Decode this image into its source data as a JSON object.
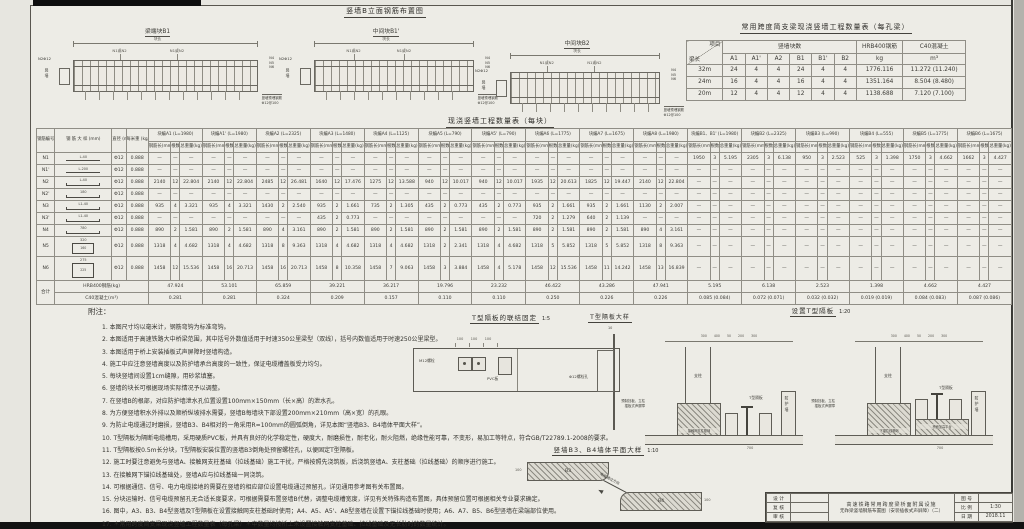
{
  "page": {
    "bg": "#e7e6e0",
    "line_color": "#59564f",
    "accent": "#121212"
  },
  "elevation": {
    "title": "竖墙B立面钢筋布置图",
    "diagrams": [
      {
        "title": "梁端块B1",
        "dim_label": "块长",
        "bar_label": "N1或N2",
        "left_label": "N2Φ12",
        "side_label": "竖墙",
        "right_labels": [
          "N4",
          "N5",
          "N6"
        ],
        "note_line1": "竖墙预埋钢筋",
        "note_line2": "Φ12@100"
      },
      {
        "title": "中间块B1'",
        "dim_label": "块长",
        "bar_label": "N1或N2",
        "left_label": "N2Φ12",
        "side_label": "竖墙",
        "right_labels": [
          "N4",
          "N5",
          "N6"
        ],
        "note_line1": "竖墙预埋钢筋",
        "note_line2": "Φ12@100"
      },
      {
        "title": "中间块B2",
        "dim_label": "块长",
        "bar_label": "N1或N2",
        "left_label": "N2Φ12",
        "side_label": "竖墙",
        "right_labels": [
          "N4",
          "N5",
          "N6"
        ],
        "note_line1": "竖墙预埋钢筋",
        "note_line2": "Φ12@100"
      }
    ]
  },
  "span_table": {
    "title": "常用跨度简支梁现浇竖墙工程数量表（每孔梁）",
    "corner_top": "项目",
    "corner_bottom": "梁长",
    "group_header": "竖墙块数",
    "block_cols": [
      "A1",
      "A1'",
      "A2",
      "B1",
      "B1'",
      "B2"
    ],
    "steel_header": "HRB400钢筋",
    "steel_unit": "kg",
    "concrete_header": "C40混凝土",
    "concrete_unit": "m³",
    "rows": [
      {
        "span": "32m",
        "blocks": [
          "24",
          "4",
          "4",
          "24",
          "4",
          "4"
        ],
        "steel": "1776.116",
        "concrete": "11.272 (11.240)"
      },
      {
        "span": "24m",
        "blocks": [
          "16",
          "4",
          "4",
          "16",
          "4",
          "4"
        ],
        "steel": "1351.164",
        "concrete": "8.504 (8.480)"
      },
      {
        "span": "20m",
        "blocks": [
          "12",
          "4",
          "4",
          "12",
          "4",
          "4"
        ],
        "steel": "1138.688",
        "concrete": "7.120 (7.100)"
      }
    ]
  },
  "main_table": {
    "title": "现浇竖墙工程数量表（每块）",
    "left_headers": [
      "钢筋编号",
      "钢 筋 大 样 (mm)",
      "直径 (mm)",
      "每米重 (kg/m)"
    ],
    "sub_headers": [
      "钢筋长(mm)",
      "根数",
      "总重量(kg)"
    ],
    "groups": [
      "块编A1 (L=1980)",
      "块编A1' (L=1980)",
      "块编A2 (L=2325)",
      "块编A3 (L=1480)",
      "块编A4 (L=1125)",
      "块编A5 (L=790)",
      "块编A5' (L=790)",
      "块编A6 (L=1775)",
      "块编A7 (L=1675)",
      "块编A8 (L=1980)",
      "块编B1、B1' (L=1980)",
      "块编B2 (L=2325)",
      "块编B3 (L=990)",
      "块编B4 (L=555)",
      "块编B5 (L=1775)",
      "块编B6 (L=1675)"
    ],
    "rows": [
      {
        "id": "N1",
        "shape": "line",
        "sketch": "L-40",
        "dia": "Φ12",
        "unit_weight": "0.888",
        "tall": 0,
        "cells": [
          null,
          null,
          null,
          null,
          null,
          null,
          null,
          null,
          null,
          null,
          [
            "1950",
            "3",
            "5.195"
          ],
          [
            "2305",
            "3",
            "6.138"
          ],
          [
            "950",
            "3",
            "2.523"
          ],
          [
            "525",
            "3",
            "1.398"
          ],
          [
            "1750",
            "3",
            "4.662"
          ],
          [
            "1662",
            "3",
            "4.427"
          ]
        ]
      },
      {
        "id": "N1'",
        "shape": "line",
        "sketch": "L-200",
        "dia": "Φ12",
        "unit_weight": "0.888",
        "tall": 0,
        "cells": [
          null,
          null,
          null,
          null,
          null,
          null,
          null,
          null,
          null,
          null,
          null,
          null,
          null,
          null,
          null,
          null
        ]
      },
      {
        "id": "N2",
        "shape": "hook",
        "sketch": "L-40",
        "dia": "Φ12",
        "unit_weight": "0.888",
        "tall": 0,
        "cells": [
          [
            "2140",
            "12",
            "22.804"
          ],
          [
            "2140",
            "12",
            "22.804"
          ],
          [
            "2485",
            "12",
            "26.481"
          ],
          [
            "1640",
            "12",
            "17.476"
          ],
          [
            "1275",
            "12",
            "13.588"
          ],
          [
            "940",
            "12",
            "10.017"
          ],
          [
            "940",
            "12",
            "10.017"
          ],
          [
            "1935",
            "12",
            "20.613"
          ],
          [
            "1825",
            "12",
            "19.447"
          ],
          [
            "2140",
            "12",
            "22.804"
          ],
          null,
          null,
          null,
          null,
          null,
          null
        ]
      },
      {
        "id": "N2'",
        "shape": "hook",
        "sketch": "180",
        "dia": "Φ12",
        "unit_weight": "0.888",
        "tall": 0,
        "cells": [
          null,
          null,
          null,
          null,
          null,
          null,
          null,
          null,
          null,
          null,
          null,
          null,
          null,
          null,
          null,
          null
        ]
      },
      {
        "id": "N3",
        "shape": "hook",
        "sketch": "L1-40",
        "dia": "Φ12",
        "unit_weight": "0.888",
        "tall": 0,
        "cells": [
          [
            "935",
            "4",
            "3.321"
          ],
          [
            "935",
            "4",
            "3.321"
          ],
          [
            "1430",
            "2",
            "2.540"
          ],
          [
            "935",
            "2",
            "1.661"
          ],
          [
            "735",
            "2",
            "1.305"
          ],
          [
            "435",
            "2",
            "0.773"
          ],
          [
            "435",
            "2",
            "0.773"
          ],
          [
            "935",
            "2",
            "1.661"
          ],
          [
            "935",
            "2",
            "1.661"
          ],
          [
            "1130",
            "2",
            "2.007"
          ],
          null,
          null,
          null,
          null,
          null,
          null
        ]
      },
      {
        "id": "N3'",
        "shape": "hook",
        "sketch": "L1-40",
        "dia": "Φ12",
        "unit_weight": "0.888",
        "tall": 0,
        "cells": [
          null,
          null,
          null,
          [
            "435",
            "2",
            "0.773"
          ],
          null,
          null,
          null,
          [
            "720",
            "2",
            "1.279"
          ],
          [
            "640",
            "2",
            "1.139"
          ],
          null,
          null,
          null,
          null,
          null,
          null,
          null
        ]
      },
      {
        "id": "N4",
        "shape": "hook",
        "sketch": "780",
        "dia": "Φ12",
        "unit_weight": "0.888",
        "tall": 0,
        "cells": [
          [
            "890",
            "2",
            "1.581"
          ],
          [
            "890",
            "2",
            "1.581"
          ],
          [
            "890",
            "4",
            "3.161"
          ],
          [
            "890",
            "2",
            "1.581"
          ],
          [
            "890",
            "2",
            "1.581"
          ],
          [
            "890",
            "2",
            "1.581"
          ],
          [
            "890",
            "2",
            "1.581"
          ],
          [
            "890",
            "2",
            "1.581"
          ],
          [
            "890",
            "2",
            "1.581"
          ],
          [
            "890",
            "4",
            "3.161"
          ],
          null,
          null,
          null,
          null,
          null,
          null
        ]
      },
      {
        "id": "N5",
        "shape": "rect",
        "sketch": "320",
        "sketch2": "160",
        "dia": "Φ12",
        "unit_weight": "0.888",
        "tall": 1,
        "cells": [
          [
            "1318",
            "4",
            "4.682"
          ],
          [
            "1318",
            "4",
            "4.682"
          ],
          [
            "1318",
            "8",
            "9.363"
          ],
          [
            "1318",
            "4",
            "4.682"
          ],
          [
            "1318",
            "4",
            "4.682"
          ],
          [
            "1318",
            "2",
            "2.341"
          ],
          [
            "1318",
            "4",
            "4.682"
          ],
          [
            "1318",
            "5",
            "5.852"
          ],
          [
            "1318",
            "5",
            "5.852"
          ],
          [
            "1318",
            "8",
            "9.363"
          ],
          null,
          null,
          null,
          null,
          null,
          null
        ]
      },
      {
        "id": "N6",
        "shape": "rect",
        "sketch": "275",
        "sketch2": "225",
        "dia": "Φ12",
        "unit_weight": "0.888",
        "tall": 2,
        "cells": [
          [
            "1458",
            "12",
            "15.536"
          ],
          [
            "1458",
            "16",
            "20.713"
          ],
          [
            "1458",
            "16",
            "20.713"
          ],
          [
            "1458",
            "8",
            "10.358"
          ],
          [
            "1458",
            "7",
            "9.063"
          ],
          [
            "1458",
            "3",
            "3.884"
          ],
          [
            "1458",
            "4",
            "5.178"
          ],
          [
            "1458",
            "12",
            "15.536"
          ],
          [
            "1458",
            "11",
            "14.242"
          ],
          [
            "1458",
            "13",
            "16.839"
          ],
          null,
          null,
          null,
          null,
          null,
          null
        ]
      }
    ],
    "totals": {
      "label": "合计",
      "steel_label": "HRB400钢筋(kg)",
      "concrete_label": "C40混凝土(m³)",
      "steel": [
        "47.924",
        "53.101",
        "65.859",
        "39.221",
        "36.217",
        "19.796",
        "23.232",
        "46.422",
        "43.286",
        "47.941",
        "5.195",
        "6.138",
        "2.523",
        "1.398",
        "4.662",
        "4.427"
      ],
      "concrete": [
        "0.281",
        "0.281",
        "0.324",
        "0.209",
        "0.157",
        "0.110",
        "0.110",
        "0.250",
        "0.226",
        "0.226",
        "0.085 (0.084)",
        "0.072 (0.071)",
        "0.032 (0.032)",
        "0.019 (0.019)",
        "0.084 (0.083)",
        "0.087 (0.086)"
      ]
    }
  },
  "notes": {
    "heading": "附注：",
    "items": [
      "1. 本图尺寸均以毫米计，钢筋弯钩为标准弯钩。",
      "2. 本图适用于高速铁路大中桥梁范围，其中括号外数值适用于时速350公里梁型（双线），括号内数值适用于时速250公里梁型。",
      "3. 本图适用于桥上安装插板式声屏障时竖墙构造。",
      "4. 施工中应注意竖墙高度以及防护墙承台高度的一致性，保证电缆槽盖板受力均匀。",
      "5. 每块竖墙间设置1cm缝隙，用砂浆填塞。",
      "6. 竖墙的块长可根据现场实际情况予以调整。",
      "7. 在竖墙B的根部，对应防护墙泄水孔位置设置100mm×150mm（长×高）的泄水孔。",
      "8. 为方便竖墙积水外排以及顺桥纵坡排水需要，竖墙B每墙块下部设置200mm×210mm（高×宽）的孔眼。",
      "9. 为防止电缆通过时磨损，竖墙B3、B4相对的一角采用R=100mm的圆弧倒角，详见本图“竖墙B3、B4墙体平面大样”。",
      "10. T型隔板为隔断电缆槽用，采用硬质PVC板，并具有良好的化学稳定性，硬度大，耐磨损性，耐老化，耐火阻燃，绝缘性能可靠，不变形，易加工等特点，符合GB/T22789.1-2008的要求。",
      "11. T型隔板按0.5m长分块，T型隔板安装位置的竖墙B3倒角处预留螺栓孔，以便固定T型隔板。",
      "12. 施工时要注意避免与竖墙A、接触网支柱基础（拉线基础）施工干扰，严格按照先浇筑板，后浇筑竖墙A、支柱基础（拉线基础）的顺序进行施工。",
      "13. 在接触网下锚拉线基础处，竖墙A应与拉线基础一同浇筑。",
      "14. 可根据通信、信号、电力电缆接地的需要在竖墙的相应部位设置电缆通过预留孔，详见通用参考图有关布置图。",
      "15. 分块运输时、信号电缆预留孔无合适长度要求，可根据需要布置竖墙B代替，调整电缆槽宽度，详见有关特殊构造布置图，具体预留位置可根据相关专业要求确定。",
      "16. 图中，A3、B3、B4型竖墙及T型隔板在设置接触网支柱基础时使用；A4、A5、A5'、A8型竖墙在设置下锚拉线基础时使用；A6、A7、B5、B6型竖墙在梁端部位使用。",
      "17. ＊常用跨度简支梁现浇竖墙工程数量表（每孔梁）＊中数量均按桥上未设置接触网支柱基础、拉线基础及无长肋时的数量统计。",
      "18. 图中，Φ表示HRB400钢筋。"
    ]
  },
  "fix_detail": {
    "title": "T型隔板的联结固定",
    "scale": "1:5",
    "dims": [
      "100",
      "100",
      "100"
    ],
    "bolt_label": "M12螺栓",
    "pvc_label": "PVC板"
  },
  "big_detail": {
    "title": "T型隔板大样",
    "top_dim": "10",
    "hole_label": "Φ12螺栓孔"
  },
  "install_detail": {
    "title": "设置T型隔板",
    "scale": "1:20",
    "sections": [
      {
        "dims": "300 400 50 200 300",
        "post_label": "支柱",
        "board_label": "T型隔板",
        "base_label": "接触网支柱基础",
        "wall_label": "防护墙",
        "side_note_1": "预制挡板、立柱",
        "side_note_2": "插板式声屏障",
        "bottom_dim": "700"
      },
      {
        "dims": "300 400 50 200 300",
        "post_label": "支柱",
        "board_label": "T型隔板",
        "base_label": "下锚拉线基础",
        "wall_label": "防护墙",
        "side_note_1": "预制挡板、立柱",
        "side_note_2": "插板式声屏障",
        "platform_label": "桥面加高平台",
        "bottom_dim": "700"
      }
    ]
  },
  "plan_detail": {
    "title": "竖墙B3、B4墙体平面大样",
    "scale": "1:10",
    "b3_label": "B3",
    "b4_label": "B4",
    "arrow_label": "电缆通过方向",
    "end_dim": "100"
  },
  "titleblock": {
    "left_rows": [
      "设 计",
      "复 核",
      "审 核"
    ],
    "project_line1": "高速铁路常用跨度梁桥面附属设施",
    "project_line2": "无砟梁竖墙钢筋布置图（安装插板式声屏障）（二）",
    "right_rows": [
      {
        "label": "图 号",
        "value": ""
      },
      {
        "label": "比 例",
        "value": "1:30"
      },
      {
        "label": "日 期",
        "value": "2018.11"
      }
    ]
  }
}
